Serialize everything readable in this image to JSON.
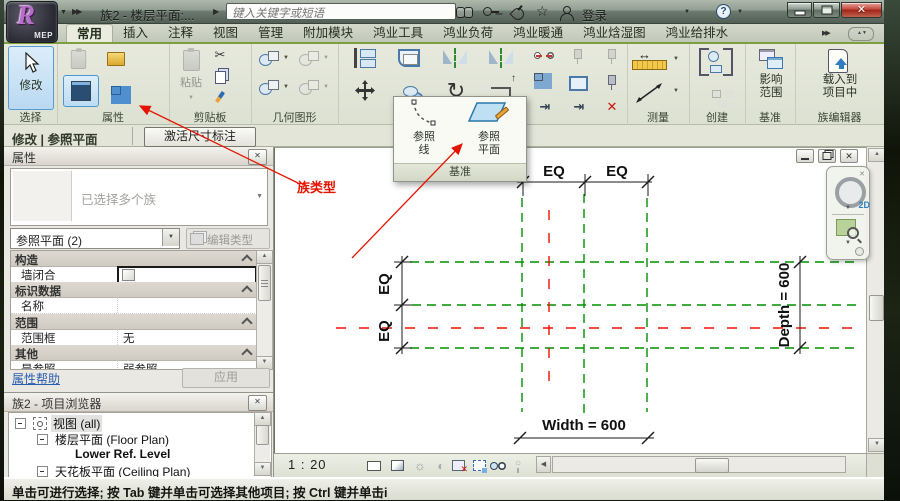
{
  "window": {
    "title": "族2 - 楼层平面:...",
    "logo_letter": "R",
    "logo_sub": "MEP",
    "sign_in_label": "登录"
  },
  "search": {
    "placeholder": "键入关键字或短语"
  },
  "ribbon": {
    "tabs": [
      {
        "label": "常用"
      },
      {
        "label": "插入"
      },
      {
        "label": "注释"
      },
      {
        "label": "视图"
      },
      {
        "label": "管理"
      },
      {
        "label": "附加模块"
      },
      {
        "label": "鸿业工具"
      },
      {
        "label": "鸿业负荷"
      },
      {
        "label": "鸿业暖通"
      },
      {
        "label": "鸿业焓湿图"
      },
      {
        "label": "鸿业给排水"
      }
    ],
    "select_panel": {
      "label": "选择",
      "modify": "修改"
    },
    "properties_panel": {
      "label": "属性"
    },
    "clipboard_panel": {
      "label": "剪贴板",
      "paste": "粘贴"
    },
    "geometry_panel": {
      "label": "几何图形"
    },
    "measure_panel": {
      "label": "测量"
    },
    "create_panel": {
      "label": "创建"
    },
    "datum_panel": {
      "label": "基准",
      "scope_line1": "影响",
      "scope_line2": "范围"
    },
    "family_editor_panel": {
      "label": "族编辑器",
      "load_line1": "载入到",
      "load_line2": "项目中"
    },
    "datum_flyout": {
      "ref_line_line1": "参照",
      "ref_line_line2": "线",
      "ref_plane_line1": "参照",
      "ref_plane_line2": "平面",
      "footer": "基准"
    }
  },
  "mode_bar": {
    "mode_label": "修改 | 参照平面",
    "activate_dim_button": "激活尺寸标注"
  },
  "annotation": {
    "family_type_text": "族类型"
  },
  "properties": {
    "title": "属性",
    "type_selector_text": "已选择多个族",
    "filter_selector": "参照平面 (2)",
    "edit_type_button": "编辑类型",
    "rows": [
      {
        "kind": "section",
        "label": "构造",
        "value": ""
      },
      {
        "kind": "checkbox",
        "label": "墙闭合",
        "value": ""
      },
      {
        "kind": "section",
        "label": "标识数据",
        "value": ""
      },
      {
        "kind": "value",
        "label": "名称",
        "value": ""
      },
      {
        "kind": "section",
        "label": "范围",
        "value": ""
      },
      {
        "kind": "value",
        "label": "范围框",
        "value": "无"
      },
      {
        "kind": "section",
        "label": "其他",
        "value": ""
      },
      {
        "kind": "value",
        "label": "是参照",
        "value": "弱参照"
      }
    ],
    "help_link": "属性帮助",
    "apply_button": "应用"
  },
  "project_browser": {
    "title": "族2 - 项目浏览器",
    "tree": [
      {
        "label": "视图 (all)"
      },
      {
        "label": "楼层平面 (Floor Plan)"
      },
      {
        "label": "Lower Ref. Level"
      },
      {
        "label": "天花板平面 (Ceiling Plan)"
      }
    ]
  },
  "canvas": {
    "eq_label": "EQ",
    "width_dim": "Width = 600",
    "depth_dim": "Depth = 600",
    "nav_2d_label": "2D"
  },
  "view_bar": {
    "scale": "1 : 20"
  },
  "status_bar": {
    "message": "单击可进行选择; 按 Tab 键并单击可选择其他项目; 按 Ctrl 键并单击i"
  },
  "colors": {
    "accent_green": "#7f9e3f",
    "ref_plane_green": "#009100",
    "center_plane_red": "#f01000",
    "annotation_red": "#e51400",
    "selection_blue": "#cde3f5"
  }
}
